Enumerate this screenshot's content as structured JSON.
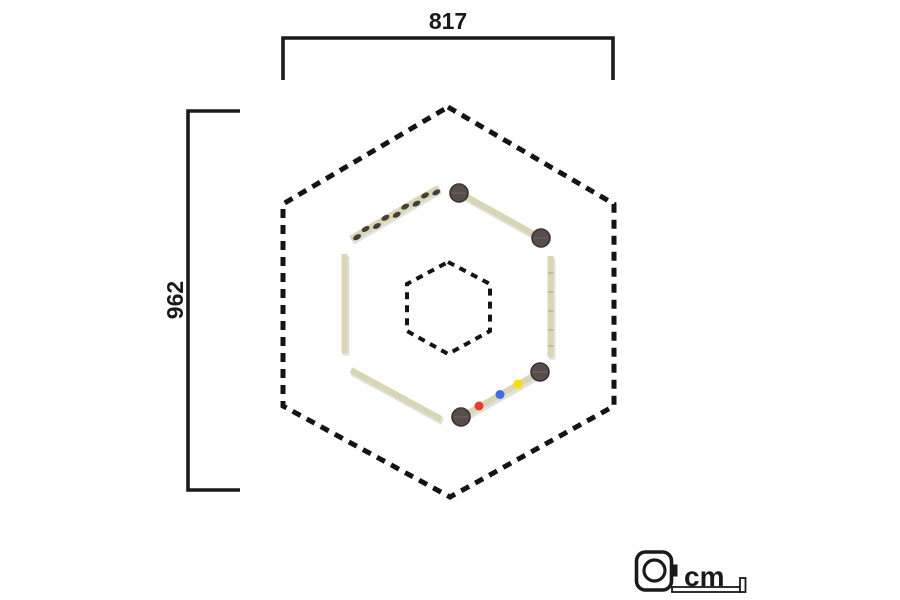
{
  "dimensions": {
    "width": "817",
    "height": "962"
  },
  "unit": {
    "label": "cm",
    "icon": "tape-measure-icon"
  },
  "structure": {
    "outer_boundary": "dashed hexagon (safety zone)",
    "inner_boundary": "dashed hexagon (center zone)",
    "beams": [
      {
        "position": "upper-left",
        "type": "balance-beam-with-stepping-marks",
        "marks": 9
      },
      {
        "position": "upper-right",
        "type": "balance-beam-on-posts",
        "posts": 2
      },
      {
        "position": "left",
        "type": "plain-balance-beam"
      },
      {
        "position": "right",
        "type": "notched-balance-beam"
      },
      {
        "position": "lower-left",
        "type": "plain-balance-beam"
      },
      {
        "position": "lower-right",
        "type": "balance-beam-on-posts-with-dots",
        "posts": 2,
        "dots": [
          "red",
          "blue",
          "yellow"
        ]
      }
    ]
  },
  "colors": {
    "ink": "#1a1a1a",
    "dash": "#141414",
    "beam": "#d9d6b6",
    "beam_shadow": "#c9c9c0",
    "beam_notch": "#b6b394",
    "mark": "#493d38",
    "post": "#584d4a",
    "post_edge": "#3d3431",
    "post_slot": "#7a6f6b",
    "dot_red": "#e73c2e",
    "dot_blue": "#3d6de2",
    "dot_yellow": "#ffdc00"
  }
}
